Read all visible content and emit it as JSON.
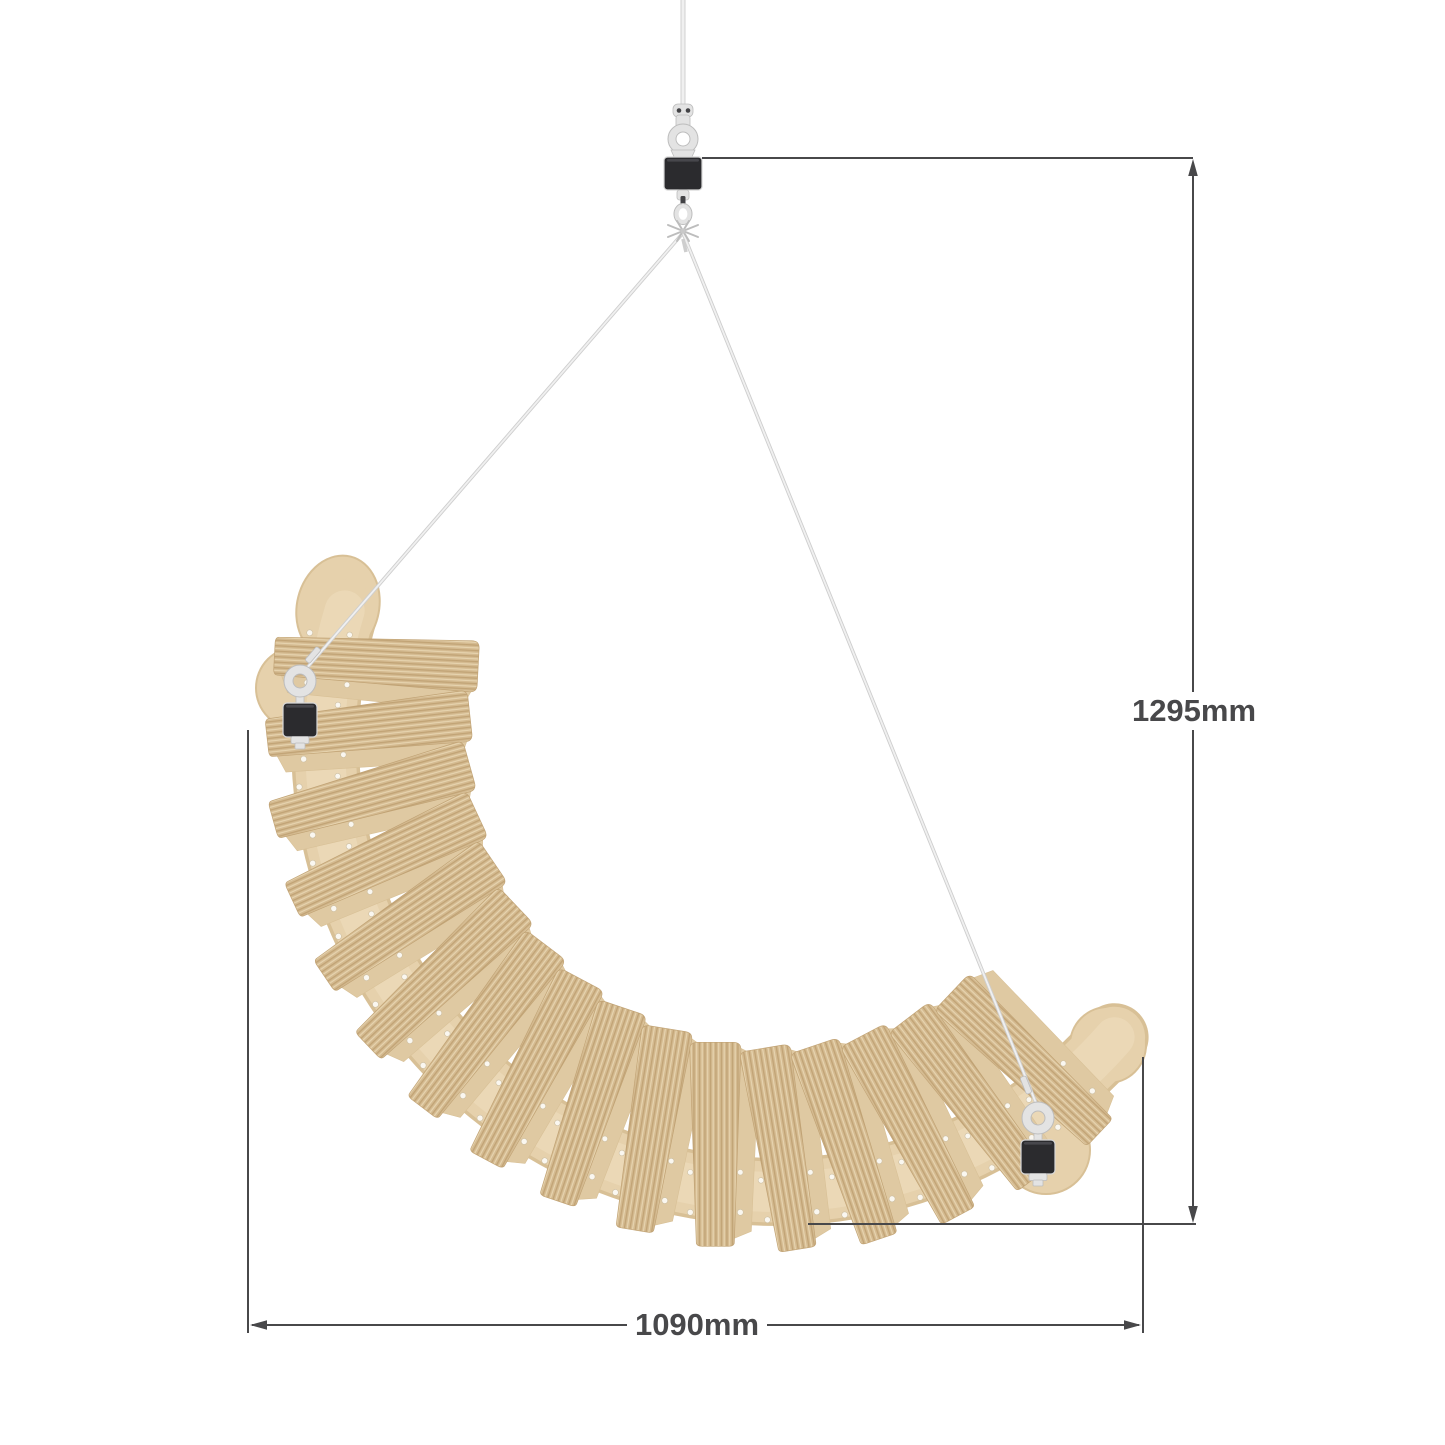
{
  "figure": {
    "slat_count": 16,
    "colors": {
      "background": "#ffffff",
      "wood": "#e6d1ac",
      "wood_edge": "#d8c096",
      "wood_highlight": "#efdfbf",
      "slat_base": "#d4ba90",
      "wood_stripe_dark": "#c1a375",
      "wood_stripe_light": "#e8d6b2",
      "slat_side": "#dfc9a2",
      "hardware_black": "#2b2b2e",
      "metal": "#e3e3e3",
      "metal_dark": "#bdbdbd",
      "cable_light": "#f0f0f0",
      "cable_shade": "#cecece",
      "dimension": "#48484a"
    }
  },
  "dimensions": {
    "vertical": {
      "label": "1295mm"
    },
    "horizontal": {
      "label": "1090mm"
    }
  }
}
